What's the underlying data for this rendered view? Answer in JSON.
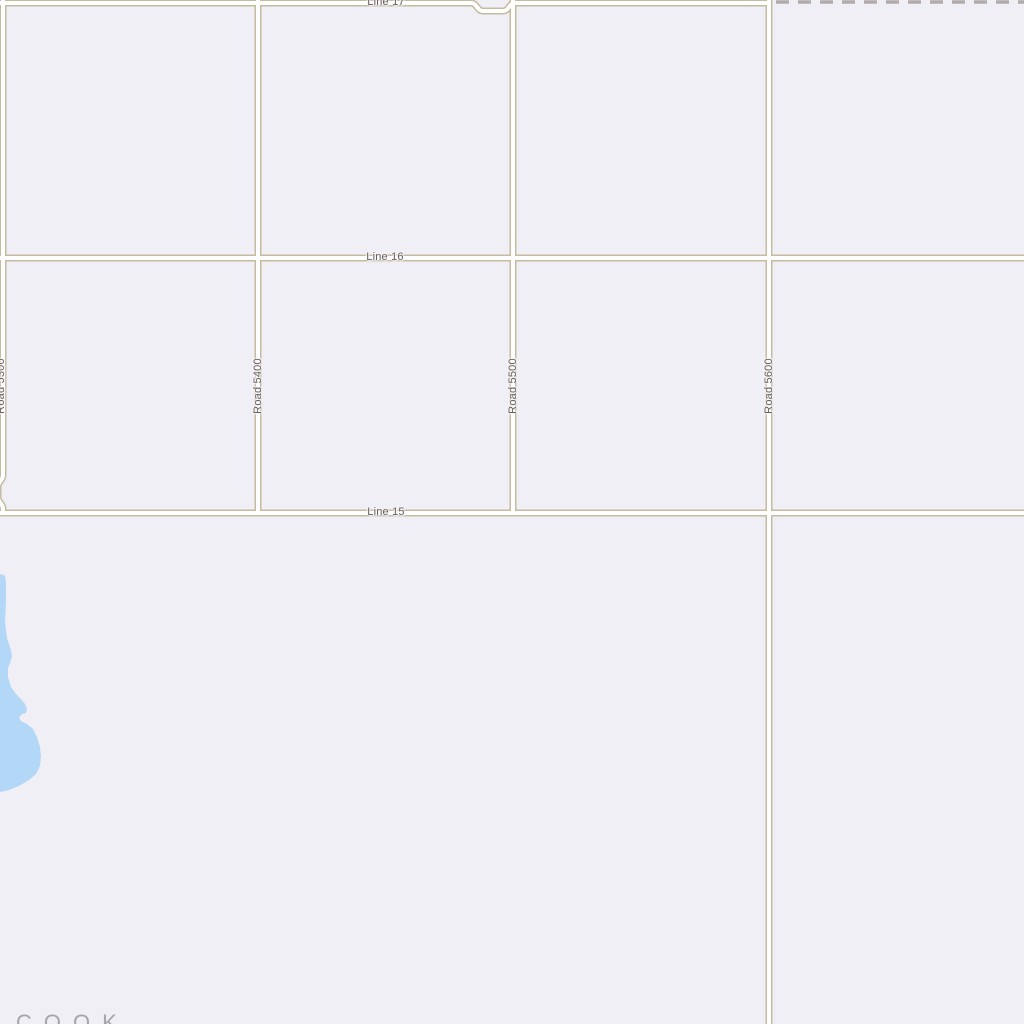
{
  "map": {
    "colors": {
      "background": "#f1eff6",
      "road_fill": "#ffffff",
      "road_casing": "#c6bba1",
      "water": "#b3d7f7",
      "boundary_dash": "#b2abab",
      "road_label_text": "#66625a",
      "area_label_text": "#a7a4ac"
    },
    "horizontal_roads": [
      {
        "label": "Line 17"
      },
      {
        "label": "Line 16"
      },
      {
        "label": "Line 15"
      }
    ],
    "vertical_roads": [
      {
        "label": "Road 5300"
      },
      {
        "label": "Road 5400"
      },
      {
        "label": "Road 5500"
      },
      {
        "label": "Road 5600"
      }
    ],
    "area_label": "COOK",
    "features": {
      "water_body": "lake-left-edge",
      "boundary": "dashed-boundary-top-right"
    }
  }
}
